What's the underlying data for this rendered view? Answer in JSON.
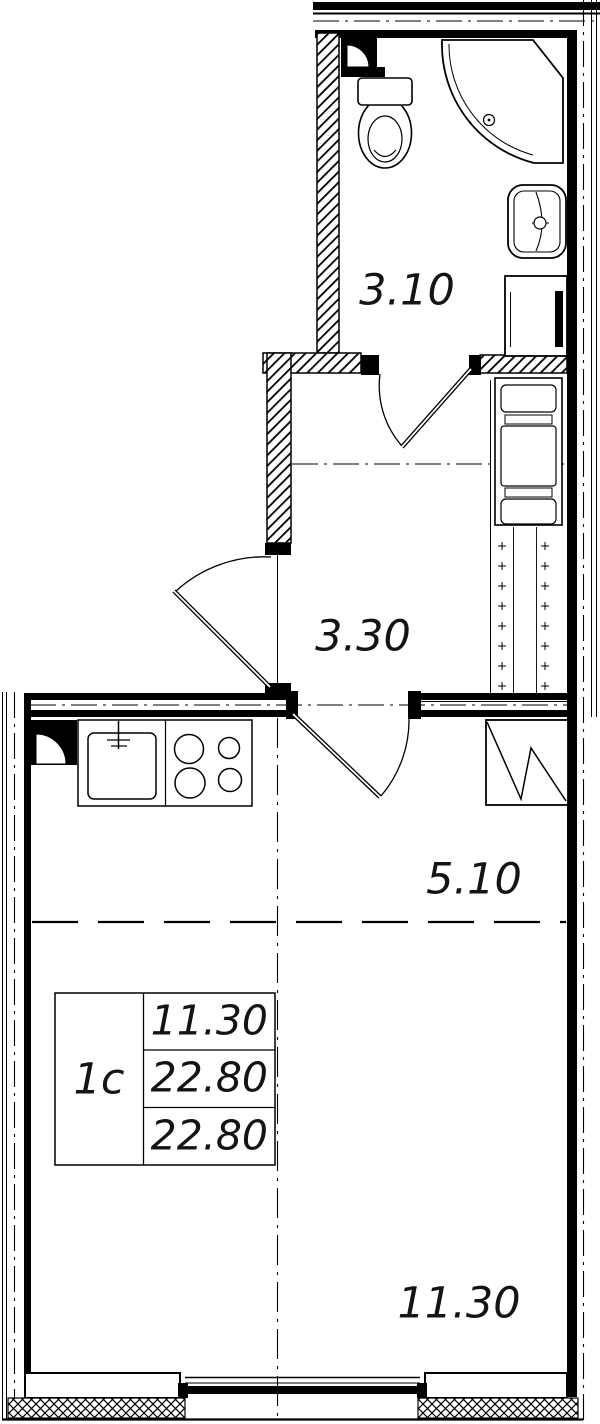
{
  "plan_title": "studio-apartment-floor-plan",
  "rooms": {
    "bathroom": "3.10",
    "hallway": "3.30",
    "kitchen": "5.10",
    "living": "11.30"
  },
  "info_box": {
    "type": "1с",
    "rows": [
      "11.30",
      "22.80",
      "22.80"
    ]
  },
  "colors": {
    "line": "#000000",
    "paper": "#ffffff"
  },
  "fixtures": {
    "toilet": "toilet-icon",
    "shower": "shower-icon",
    "bathroom_sink": "bathroom-sink-icon",
    "washing_machine": "washing-machine-icon",
    "wardrobe": "wardrobe-icon",
    "ventilation_shaft": "ventilation-shaft",
    "kitchen_sink": "kitchen-sink-icon",
    "stove": "stove-icon",
    "fridge": "fridge-icon",
    "vent_duct": "vent-duct-icon",
    "window": "window-icon",
    "door": "door-icon"
  }
}
